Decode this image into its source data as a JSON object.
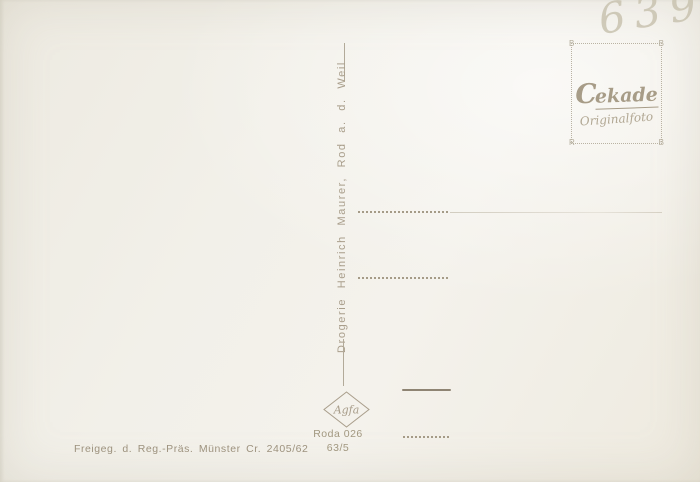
{
  "postcard": {
    "handwritten_number": "6395",
    "stamp_box": {
      "brand_initial": "C",
      "brand_rest": "ekade",
      "brand_full": "Cekade",
      "subtitle": "Originalfoto",
      "corners": [
        "B",
        "B",
        "R",
        "B"
      ]
    },
    "publisher_line": "Drogerie  Heinrich  Maurer,  Rod  a. d.  Weil",
    "paper_logo": "Agfa",
    "order_number": "Roda 026",
    "order_code": "63/5",
    "approval_line": "Freigeg.  d.  Reg.-Präs.  Münster  Cr.  2405/62",
    "colors": {
      "paper": "#f2f0e9",
      "ink": "#a1977f",
      "pencil": "#c9c3b0",
      "divider": "#b2aa99"
    }
  }
}
